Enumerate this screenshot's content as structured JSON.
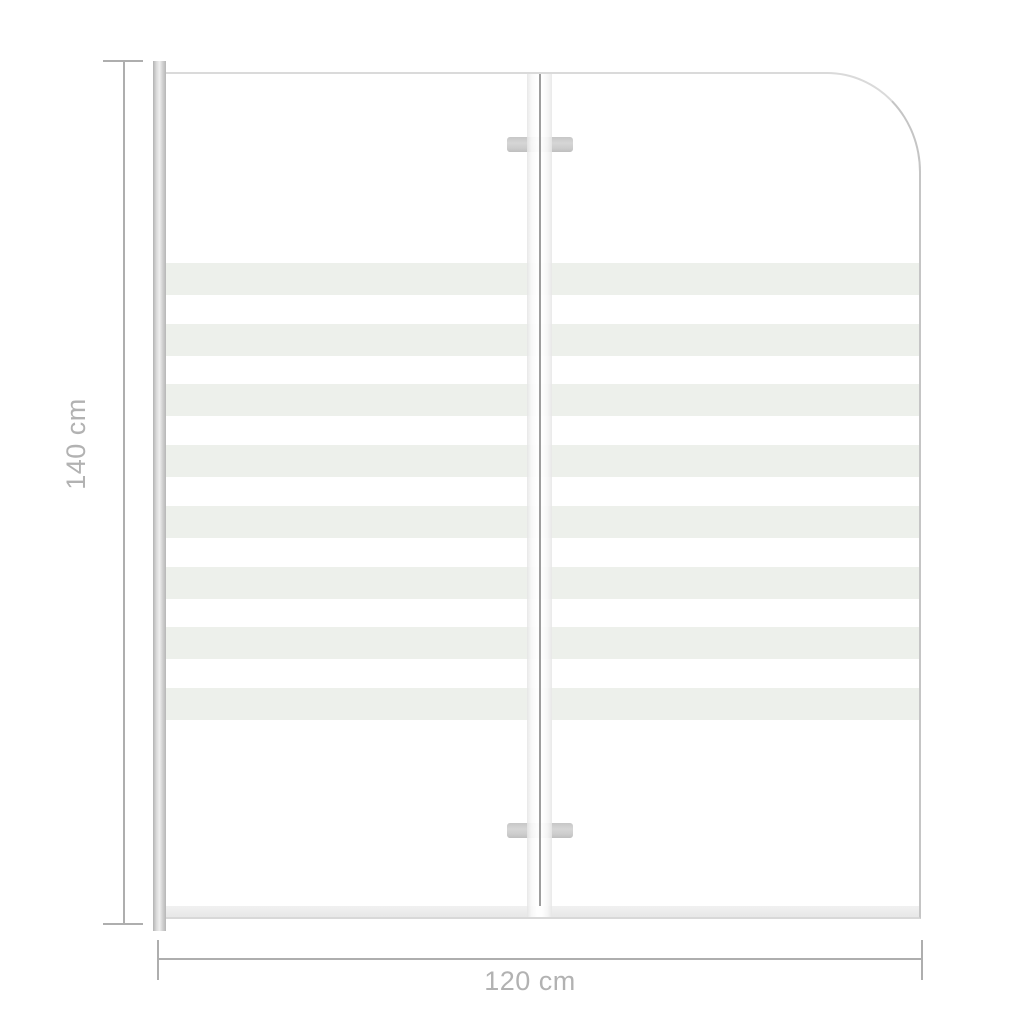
{
  "diagram": {
    "kind": "product-dimension-diagram",
    "depicts": "two-panel folding bath shower screen with frosted stripes",
    "height_dimension": {
      "label": "140 cm"
    },
    "width_dimension": {
      "label": "120 cm"
    },
    "glass": {
      "stripe_count": 8
    },
    "colors": {
      "dimension_line": "#aeaeae",
      "dimension_text": "#b2b2b2",
      "stripe": "#edf0eb",
      "frame": "#c6c6c6",
      "hinge": "#cccccc",
      "rail": "#eaeaea",
      "glass_edge": "#c5c5c5"
    }
  }
}
